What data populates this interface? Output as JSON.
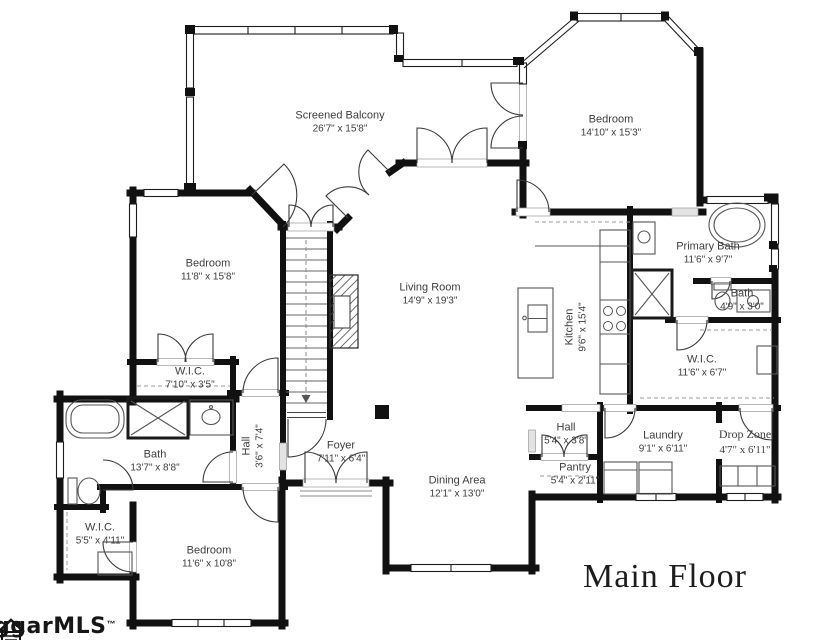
{
  "title": "Main Floor",
  "watermark": {
    "text": "ggarMLS",
    "tm": "™"
  },
  "rooms": [
    {
      "id": "screened-balcony",
      "name": "Screened Balcony",
      "dims": "26'7\" x 15'8\""
    },
    {
      "id": "bedroom-northeast",
      "name": "Bedroom",
      "dims": "14'10\" x 15'3\""
    },
    {
      "id": "bedroom-west",
      "name": "Bedroom",
      "dims": "11'8\" x 15'8\""
    },
    {
      "id": "living-room",
      "name": "Living Room",
      "dims": "14'9\" x 19'3\""
    },
    {
      "id": "kitchen",
      "name": "Kitchen",
      "dims": "9'6\" x 15'4\""
    },
    {
      "id": "primary-bath",
      "name": "Primary Bath",
      "dims": "11'6\" x 9'7\""
    },
    {
      "id": "bath-small",
      "name": "Bath",
      "dims": "4'9\" x 3'0\""
    },
    {
      "id": "wic-primary",
      "name": "W.I.C.",
      "dims": "11'6\" x 6'7\""
    },
    {
      "id": "wic-west",
      "name": "W.I.C.",
      "dims": "7'10\" x 3'5\""
    },
    {
      "id": "bath-main",
      "name": "Bath",
      "dims": "13'7\" x 8'8\""
    },
    {
      "id": "hall-center",
      "name": "Hall",
      "dims": "3'6\" x 7'4\""
    },
    {
      "id": "foyer",
      "name": "Foyer",
      "dims": "7'11\" x 6'4\""
    },
    {
      "id": "hall-rear",
      "name": "Hall",
      "dims": "5'4\" x 3'8\""
    },
    {
      "id": "laundry",
      "name": "Laundry",
      "dims": "9'1\" x 6'11\""
    },
    {
      "id": "drop-zone",
      "name": "Drop Zone",
      "dims": "4'7\" x 6'11\""
    },
    {
      "id": "pantry",
      "name": "Pantry",
      "dims": "5'4\" x 2'11\""
    },
    {
      "id": "dining-area",
      "name": "Dining Area",
      "dims": "12'1\" x 13'0\""
    },
    {
      "id": "wic-south",
      "name": "W.I.C.",
      "dims": "5'5\" x 4'11\""
    },
    {
      "id": "bedroom-south",
      "name": "Bedroom",
      "dims": "11'6\" x 10'8\""
    }
  ]
}
